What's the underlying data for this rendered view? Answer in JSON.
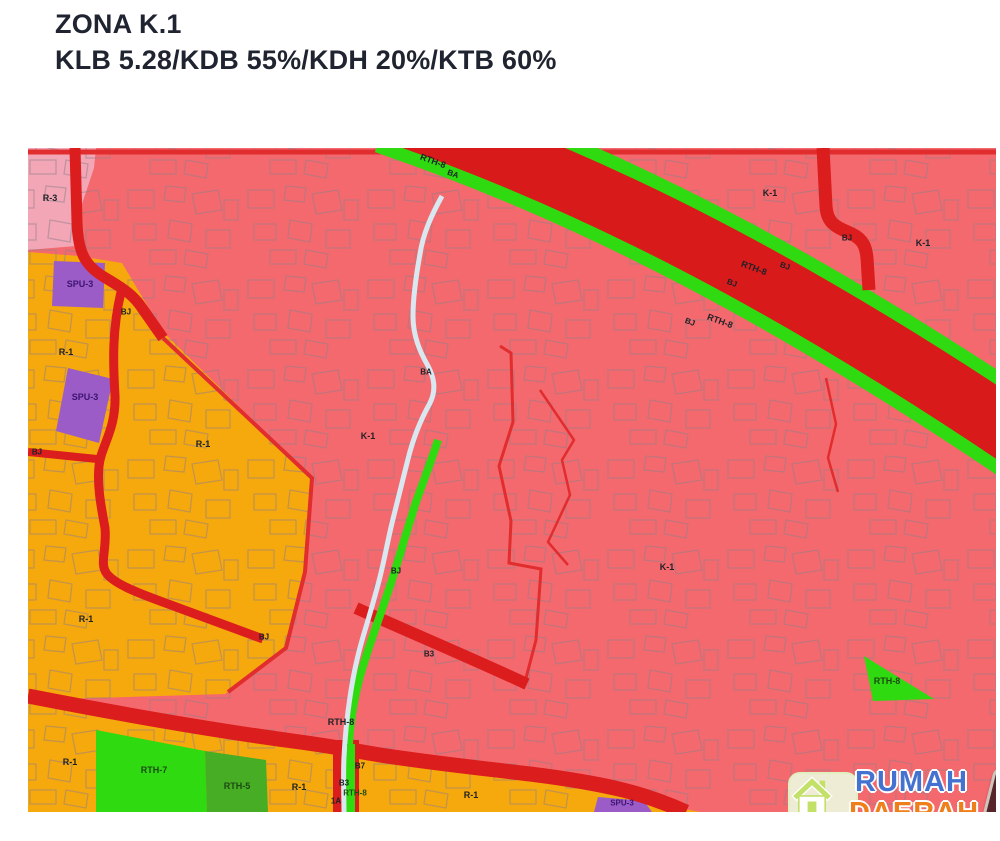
{
  "page": {
    "title": "ZONA K.1",
    "subtitle": "KLB 5.28/KDB 55%/KDH 20%/KTB 60%"
  },
  "map": {
    "colors": {
      "k1": "#f4696e",
      "r3": "#f2a6b6",
      "r1": "#f6a90c",
      "road": "#dc1d1d",
      "band": "#d91a1a",
      "green": "#2fdb10",
      "rth5": "#46ad24",
      "spu": "#9b5cc8",
      "river": "#d9e8f0",
      "bound": "#e12d2d",
      "parcel": "#8f7d88"
    },
    "label_colors": {
      "default": "#1d2126",
      "green": "#1d4a14",
      "purple": "#3d1470"
    },
    "labels": [
      {
        "text": "R-3",
        "x": 50,
        "y": 198
      },
      {
        "text": "SPU-3",
        "x": 80,
        "y": 284,
        "color": "purple"
      },
      {
        "text": "BJ",
        "x": 126,
        "y": 312,
        "size": 8
      },
      {
        "text": "R-1",
        "x": 66,
        "y": 352
      },
      {
        "text": "SPU-3",
        "x": 85,
        "y": 397,
        "color": "purple"
      },
      {
        "text": "BJ",
        "x": 37,
        "y": 452,
        "size": 8
      },
      {
        "text": "R-1",
        "x": 203,
        "y": 444
      },
      {
        "text": "R-1",
        "x": 86,
        "y": 619
      },
      {
        "text": "BJ",
        "x": 264,
        "y": 637,
        "size": 8
      },
      {
        "text": "R-1",
        "x": 70,
        "y": 762
      },
      {
        "text": "RTH-7",
        "x": 154,
        "y": 770,
        "color": "green"
      },
      {
        "text": "RTH-5",
        "x": 237,
        "y": 786,
        "color": "green"
      },
      {
        "text": "R-1",
        "x": 299,
        "y": 787
      },
      {
        "text": "K-1",
        "x": 368,
        "y": 436
      },
      {
        "text": "BA",
        "x": 426,
        "y": 372,
        "size": 8
      },
      {
        "text": "RTH-8",
        "x": 433,
        "y": 161,
        "rot": 20
      },
      {
        "text": "BA",
        "x": 453,
        "y": 174,
        "rot": 20,
        "size": 8
      },
      {
        "text": "BJ",
        "x": 396,
        "y": 571,
        "size": 8
      },
      {
        "text": "B3",
        "x": 429,
        "y": 654,
        "size": 8
      },
      {
        "text": "RTH-8",
        "x": 341,
        "y": 722
      },
      {
        "text": "B7",
        "x": 360,
        "y": 766,
        "size": 8
      },
      {
        "text": "B3",
        "x": 344,
        "y": 783,
        "size": 8
      },
      {
        "text": "RTH-8",
        "x": 355,
        "y": 793,
        "color": "green",
        "size": 8
      },
      {
        "text": "1A",
        "x": 336,
        "y": 801,
        "size": 8
      },
      {
        "text": "R-1",
        "x": 471,
        "y": 795
      },
      {
        "text": "K-1",
        "x": 667,
        "y": 567
      },
      {
        "text": "BJ",
        "x": 690,
        "y": 322,
        "rot": 20,
        "size": 8
      },
      {
        "text": "RTH-8",
        "x": 720,
        "y": 321,
        "rot": 20
      },
      {
        "text": "BJ",
        "x": 732,
        "y": 283,
        "rot": 20,
        "size": 8
      },
      {
        "text": "RTH-8",
        "x": 754,
        "y": 268,
        "rot": 20
      },
      {
        "text": "BJ",
        "x": 785,
        "y": 266,
        "rot": 20,
        "size": 8
      },
      {
        "text": "K-1",
        "x": 770,
        "y": 193
      },
      {
        "text": "BJ",
        "x": 847,
        "y": 238,
        "size": 8
      },
      {
        "text": "K-1",
        "x": 923,
        "y": 243
      },
      {
        "text": "RTH-8",
        "x": 887,
        "y": 681,
        "color": "green"
      },
      {
        "text": "SPU-3",
        "x": 622,
        "y": 803,
        "color": "purple",
        "size": 8
      }
    ]
  },
  "watermark": {
    "brand_top": "RUMAH",
    "brand_bottom": "DAERAH",
    "badge": ".COM"
  }
}
